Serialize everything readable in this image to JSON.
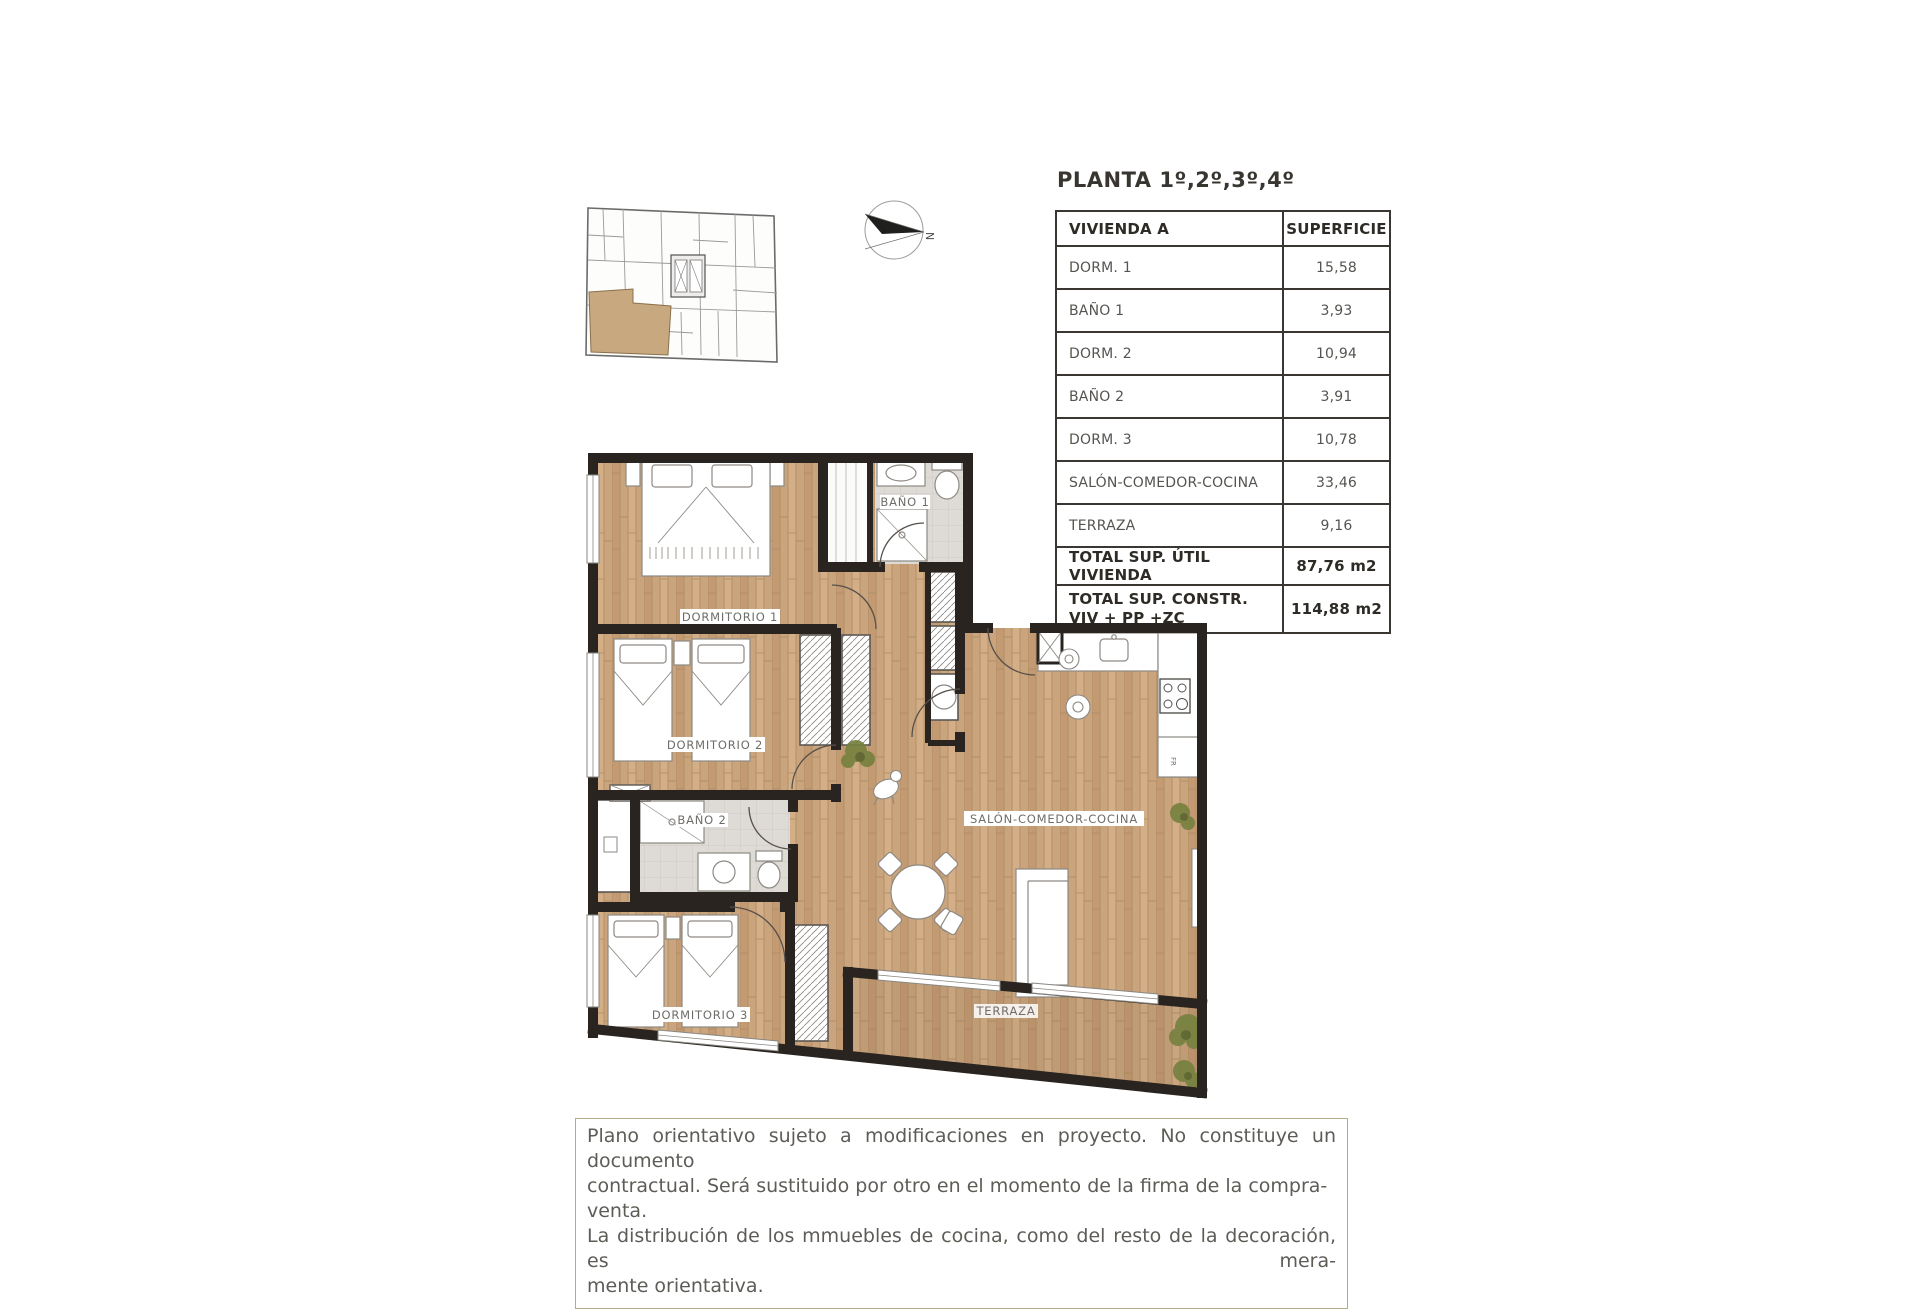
{
  "document": {
    "title": "PLANTA 1º,2º,3º,4º"
  },
  "compass": {
    "north_label": "N"
  },
  "surface_table": {
    "headers": {
      "unit": "VIVIENDA A",
      "surface": "SUPERFICIE"
    },
    "rows": [
      {
        "label": "DORM. 1",
        "value": "15,58"
      },
      {
        "label": "BAÑO 1",
        "value": "3,93"
      },
      {
        "label": "DORM. 2",
        "value": "10,94"
      },
      {
        "label": "BAÑO 2",
        "value": "3,91"
      },
      {
        "label": "DORM. 3",
        "value": "10,78"
      },
      {
        "label": "SALÓN-COMEDOR-COCINA",
        "value": "33,46"
      },
      {
        "label": "TERRAZA",
        "value": "9,16"
      }
    ],
    "total_useful": {
      "label": "TOTAL SUP. ÚTIL VIVIENDA",
      "value": "87,76 m2"
    },
    "total_built": {
      "label_line1": "TOTAL SUP. CONSTR.",
      "label_line2": "VIV + PP +ZC",
      "value": "114,88 m2"
    }
  },
  "floor_plan": {
    "labels": {
      "dorm1": "DORMITORIO 1",
      "bano1": "BAÑO 1",
      "dorm2": "DORMITORIO 2",
      "bano2": "BAÑO 2",
      "dorm3": "DORMITORIO 3",
      "salon": "SALÓN-COMEDOR-COCINA",
      "terraza": "TERRAZA",
      "fridge": "FR"
    }
  },
  "disclaimer": {
    "lines": [
      "Plano orientativo sujeto a modificaciones en proyecto. No constituye un documento",
      "contractual. Será sustituido por otro en el momento de la firma de la compra-venta.",
      "La distribución de los mmuebles de cocina, como del resto de la decoración, es mera-",
      "mente orientativa."
    ]
  },
  "colors": {
    "wall": "#29241f",
    "wood": "#caa47c",
    "tile": "#dedbd7",
    "unit_highlight": "#c8a87e",
    "disclaimer_border": "#b3ac8c"
  }
}
